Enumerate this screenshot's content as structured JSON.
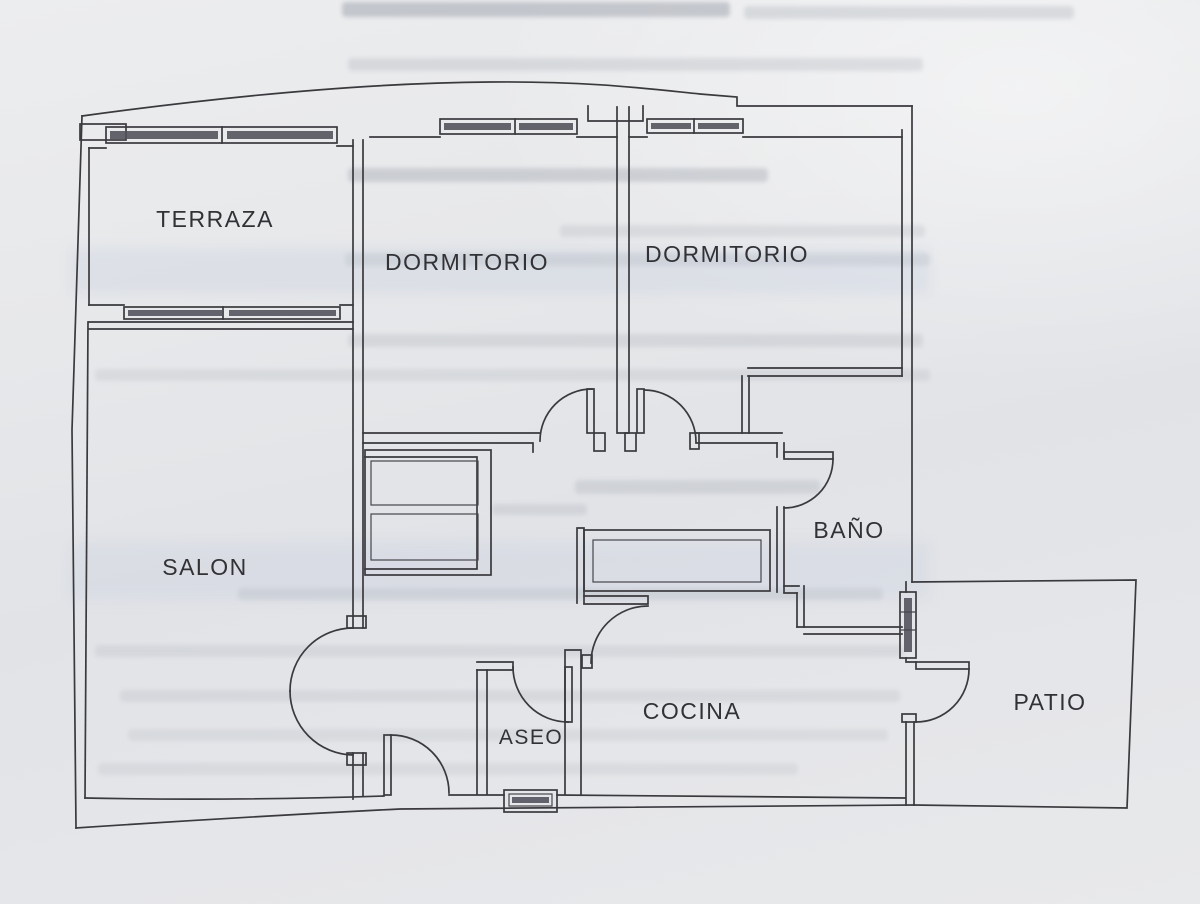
{
  "document": {
    "kind": "scanned-floor-plan-photo",
    "language": "es"
  },
  "floor_plan": {
    "rooms": [
      {
        "id": "terraza",
        "label": "TERRAZA"
      },
      {
        "id": "dormitorio-1",
        "label": "DORMITORIO"
      },
      {
        "id": "dormitorio-2",
        "label": "DORMITORIO"
      },
      {
        "id": "salon",
        "label": "SALON"
      },
      {
        "id": "bano",
        "label": "BAÑO"
      },
      {
        "id": "cocina",
        "label": "COCINA"
      },
      {
        "id": "aseo",
        "label": "ASEO"
      },
      {
        "id": "patio",
        "label": "PATIO"
      }
    ],
    "colors": {
      "paper": "#e6e7e9",
      "ink": "#3a3a3e",
      "window_glass": "#50505a"
    }
  }
}
